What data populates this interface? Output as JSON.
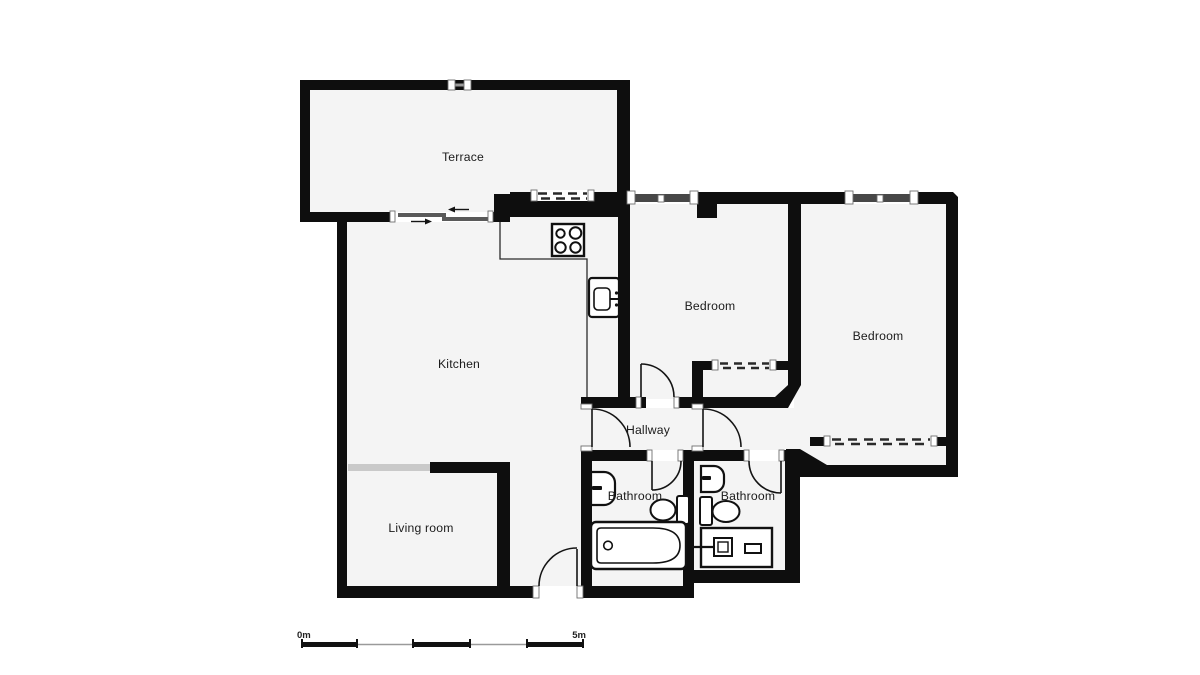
{
  "plan": {
    "title": "apartment-floor-plan",
    "rooms": {
      "terrace": {
        "label": "Terrace"
      },
      "kitchen": {
        "label": "Kitchen"
      },
      "living_room": {
        "label": "Living room"
      },
      "bedroom_1": {
        "label": "Bedroom"
      },
      "bedroom_2": {
        "label": "Bedroom"
      },
      "hallway": {
        "label": "Hallway"
      },
      "bathroom_1": {
        "label": "Bathroom"
      },
      "bathroom_2": {
        "label": "Bathroom"
      }
    },
    "fixtures": [
      "stove-icon",
      "kitchen-sink-icon",
      "bathtub-icon",
      "toilet-icon",
      "washer-icon",
      "hand-basin-icon",
      "sliding-door-icon"
    ],
    "scale_bar": {
      "start_label": "0m",
      "end_label": "5m"
    },
    "colors": {
      "wall": "#0e0e0e",
      "floor": "#f4f4f4",
      "background": "#ffffff",
      "window_glass": "#474747",
      "wide_opening_gray": "#c9c9c9",
      "slider_gray": "#5a5a5a",
      "scale_gray": "#9a9a9a",
      "label_text": "#1b1b1b"
    }
  }
}
